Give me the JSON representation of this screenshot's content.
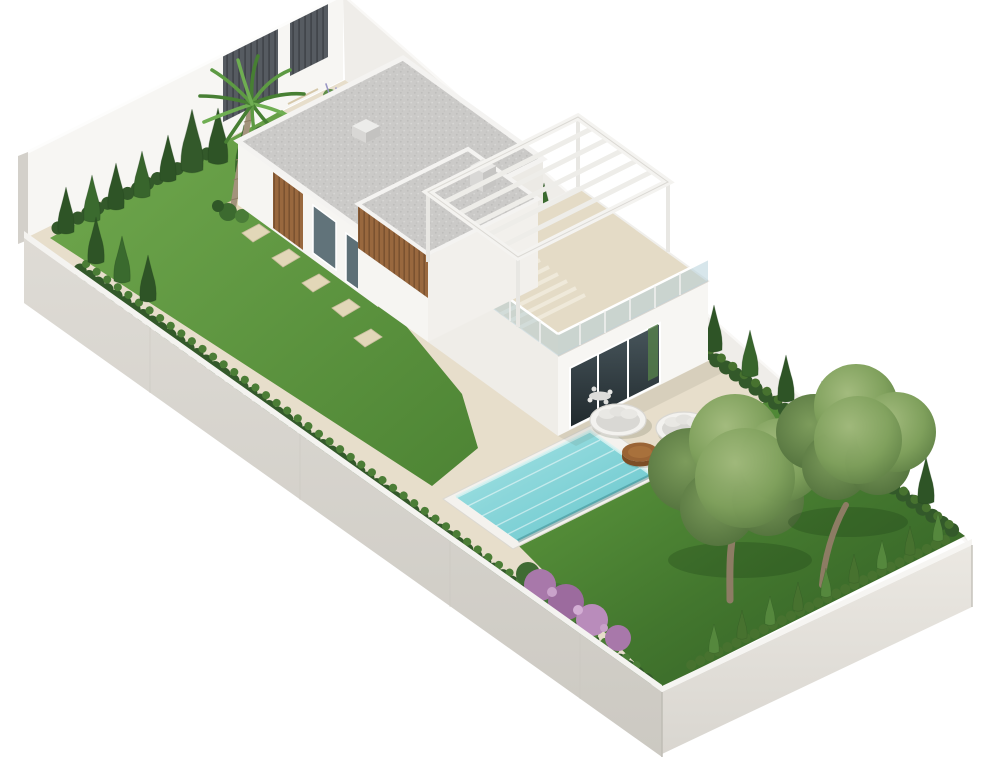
{
  "image": {
    "title": "3D isometric architectural rendering of a modern two-storey villa on a long walled garden plot",
    "type": "architectural-render"
  },
  "colors": {
    "background": "#ffffff",
    "wall_white": "#f7f6f3",
    "wall_inner_shaded": "#efede9",
    "wall_outer": "#d8d5cf",
    "wall_outer_se": "#e6e3dd",
    "gate_panel": "#565b61",
    "terrace_sand": "#e7decb",
    "stone_path": "#e2d7b8",
    "lawn_light": "#6aa24b",
    "lawn_dark": "#2f5a24",
    "hedge_dark": "#33592a",
    "hedge_light": "#55883d",
    "roof_gravel": "#cbcac8",
    "wood_slats": "#99683e",
    "pool_coping": "#f4f2ee",
    "pool_water": "#7fd0d5",
    "glass": "#aecdd8",
    "daybed_cushion": "#d9d8d4",
    "table_wood": "#9a6435",
    "olive_foliage": "#7fa05c",
    "palm_green": "#5d9a43",
    "flower_purple": "#a878aa",
    "tree_trunk": "#8d7c64"
  },
  "scene": {
    "elements": [
      {
        "name": "boundary-wall",
        "label": "White perimeter wall around plot"
      },
      {
        "name": "entrance-gate",
        "label": "Dark slatted entrance gate panels on street wall"
      },
      {
        "name": "palm-tree",
        "label": "Palm tree in upper garden"
      },
      {
        "name": "cypress-hedge",
        "label": "Cypress hedge rows along walls"
      },
      {
        "name": "stepping-stone-path",
        "label": "Stepping stone path across lawn"
      },
      {
        "name": "villa",
        "label": "Modern white villa with wood slat cladding"
      },
      {
        "name": "gravel-roof",
        "label": "Flat gravel roofs with skylight and chimney"
      },
      {
        "name": "roof-terrace",
        "label": "Roof terrace with glass balustrade"
      },
      {
        "name": "pergola",
        "label": "White beam pergola over terrace"
      },
      {
        "name": "sliding-glass-doors",
        "label": "Sliding glass doors with interior dining set"
      },
      {
        "name": "swimming-pool",
        "label": "Rectangular turquoise swimming pool"
      },
      {
        "name": "daybeds",
        "label": "Two round outdoor daybeds"
      },
      {
        "name": "coffee-table",
        "label": "Round wooden coffee table"
      },
      {
        "name": "olive-trees",
        "label": "Two olive trees on lower lawn"
      },
      {
        "name": "flowering-shrub",
        "label": "Purple flowering shrub along hedge"
      },
      {
        "name": "lawn",
        "label": "Upper and lower lawn areas"
      }
    ]
  }
}
